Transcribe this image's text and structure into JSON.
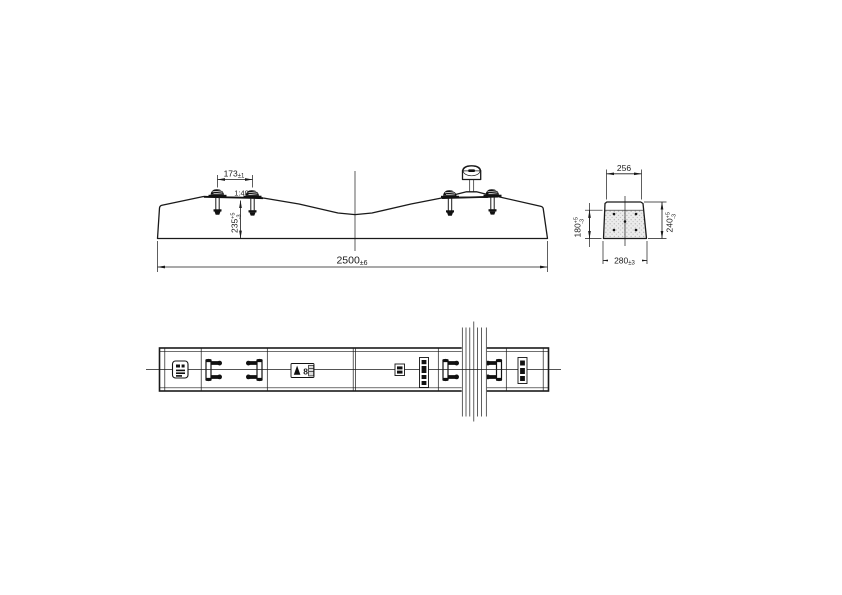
{
  "colors": {
    "ink": "#1a1a1a",
    "bg": "#ffffff",
    "concrete_dot": "#9a9a9a"
  },
  "dims": {
    "rail_spacing": {
      "main": "173",
      "tol": "±1"
    },
    "seat_slope": {
      "label": "1:40"
    },
    "seat_height": {
      "main": "235",
      "sup": "+5",
      "sub": "-3"
    },
    "overall_length": {
      "main": "2500",
      "tol": "±6"
    },
    "section_top_width": {
      "main": "256"
    },
    "section_bottom_width": {
      "main": "280",
      "tol": "±3"
    },
    "section_side_height": {
      "main": "180",
      "sup": "+5",
      "sub": "-3"
    },
    "section_total_height": {
      "main": "240",
      "sup": "+5",
      "sub": "-3"
    }
  },
  "stamps": {
    "mold_digit": "8"
  }
}
